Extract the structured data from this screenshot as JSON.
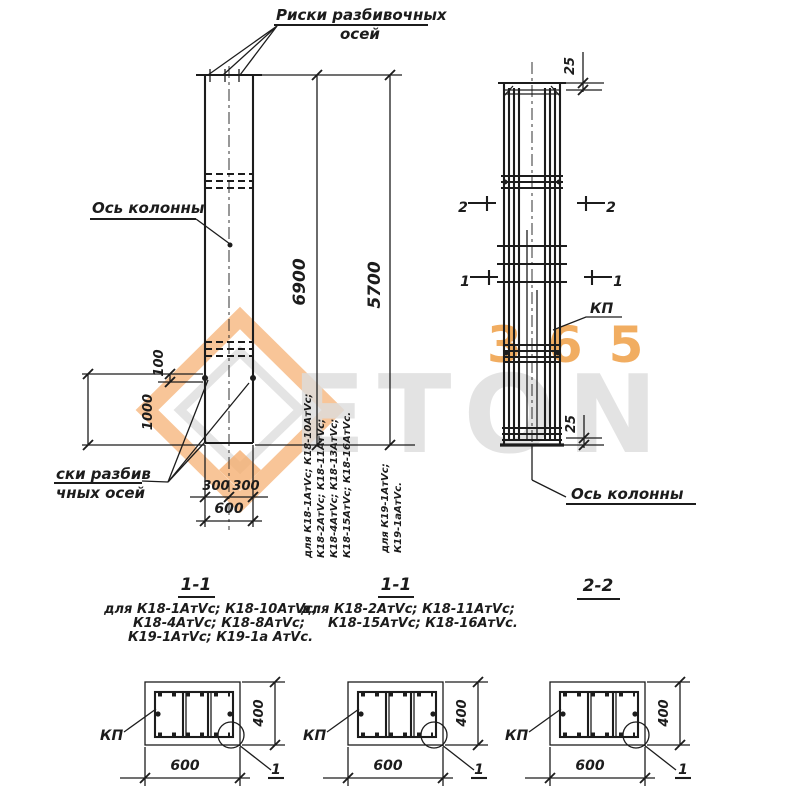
{
  "watermark": {
    "eton": "ETON",
    "num": "365",
    "orange": "#ef9b3e",
    "gray": "#d9d9d9"
  },
  "labels": {
    "top_axis_line1": "Риски разбивочных",
    "top_axis_line2": "осей",
    "axis_left": "Ось колонны",
    "axis_right": "Ось колонны",
    "bottom_axis_line1": "ски разбив",
    "bottom_axis_line2": "чных осей",
    "kp_right_view": "КП"
  },
  "dimensions": {
    "len1": "6900",
    "len2": "5700",
    "emb": "1000",
    "top_off": "100",
    "half1": "300",
    "half2": "300",
    "width": "600",
    "cover_top": "25",
    "cover_bottom": "25"
  },
  "marks": {
    "m2": "2",
    "m1": "1"
  },
  "applicability": {
    "under_len1": [
      "для К18-1АтVс; К18-10АтVс;",
      "К18-2АтVс; К18-11АтVс;",
      "К18-4АтVс; К18-13АтVс;",
      "К18-15АтVс; К18-16АтVс."
    ],
    "under_len2": [
      "для К19-1АтVс;",
      "К19-1аАтVс."
    ]
  },
  "sections": {
    "a_title": "1-1",
    "b_title": "1-1",
    "c_title": "2-2",
    "a_caption": [
      "для К18-1АтVс; К18-10АтVс;",
      "К18-4АтVс; К18-8АтVс;",
      "К19-1АтVс; К19-1а АтVс."
    ],
    "b_caption": [
      "для К18-2АтVс; К18-11АтVс;",
      "К18-15АтVс; К18-16АтVс."
    ]
  },
  "cross_sections": [
    {
      "kp": "КП",
      "width": "600",
      "height": "400",
      "detail": "1"
    },
    {
      "kp": "КП",
      "width": "600",
      "height": "400",
      "detail": "1"
    },
    {
      "kp": "КП",
      "width": "600",
      "height": "400",
      "detail": "1"
    }
  ]
}
